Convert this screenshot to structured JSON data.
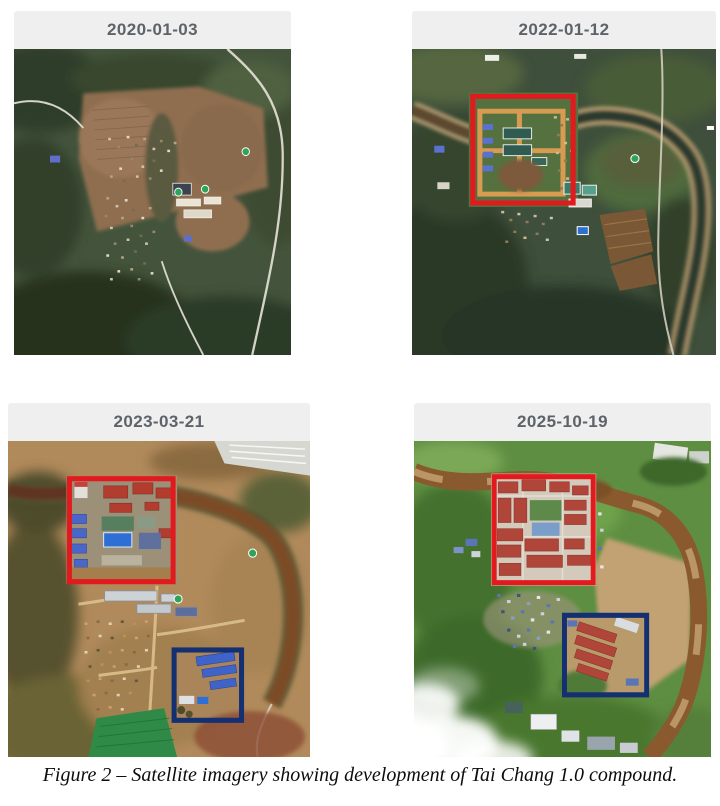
{
  "caption": "Figure 2 – Satellite imagery showing development of Tai Chang 1.0 compound.",
  "colors": {
    "annotation_red": "#e21a1d",
    "annotation_blue": "#152f73",
    "header_text": "#5d6368"
  },
  "panels": [
    {
      "date": "2020-01-03"
    },
    {
      "date": "2022-01-12",
      "red_box": {
        "x": 60,
        "y": 48,
        "w": 99,
        "h": 108,
        "color": "#e21a1d"
      }
    },
    {
      "date": "2023-03-21",
      "red_box": {
        "x": 61,
        "y": 37,
        "w": 103,
        "h": 101,
        "color": "#e21a1d"
      },
      "blue_box": {
        "x": 165,
        "y": 205,
        "w": 67,
        "h": 69,
        "color": "#152f73"
      }
    },
    {
      "date": "2025-10-19",
      "red_box": {
        "x": 81,
        "y": 35,
        "w": 100,
        "h": 104,
        "color": "#e21a1d"
      },
      "blue_box": {
        "x": 152,
        "y": 171,
        "w": 83,
        "h": 78,
        "color": "#152f73"
      }
    }
  ]
}
